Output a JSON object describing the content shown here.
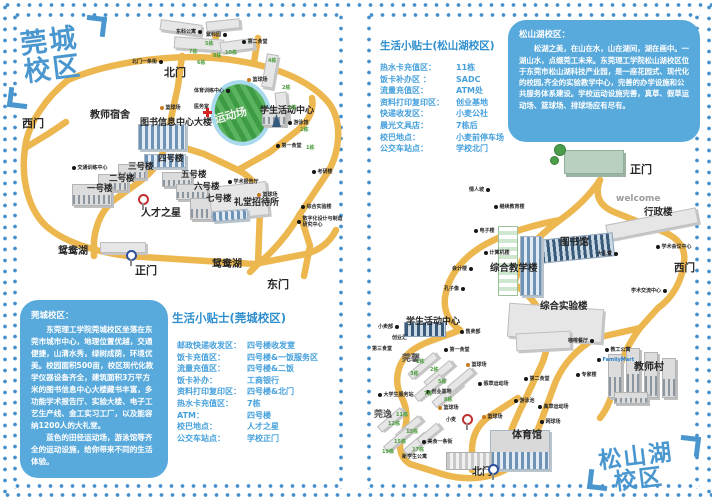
{
  "colors": {
    "accent_blue": "#2f8fce",
    "box_blue": "#58a9dc",
    "road_yellow": "#edb74f",
    "dot_blue": "#4590cd",
    "field_green": "#3d9b44"
  },
  "left": {
    "logo": {
      "line1": "莞城",
      "line2": "校区"
    },
    "intro": {
      "title": "莞城校区：",
      "p1": "东莞理工学院莞城校区坐落在东莞市城市中心，地理位置优越，交通便捷，山清水秀，绿树成荫，环境优美。校园面积500亩，校区现代化教学仪器设备齐全，建筑面积3万平方米的图书信息中心大楼藏书丰富，多功能学术报告厅、实验大楼、电子工艺生产线、金工实习工厂，以及能容纳1200人的大礼堂。",
      "p2": "蓝色的田径运动场，游泳馆等齐全的运动设施，给你带来不同的生活体验。"
    },
    "tips": {
      "title": "生活小贴士(莞城校区)",
      "rows": [
        [
          "邮政快递收发区：",
          "四号楼收发室"
        ],
        [
          "饭卡充值区：",
          "四号楼&一饭服务区"
        ],
        [
          "流量充值区：",
          "四号楼&二饭"
        ],
        [
          "饭卡补办：",
          "工商银行"
        ],
        [
          "资料打印复印区：",
          "四号楼&北门"
        ],
        [
          "热水卡充值区：",
          "7栋"
        ],
        [
          "ATM：",
          "四号楼"
        ],
        [
          "校巴地点：",
          "人才之星"
        ],
        [
          "公交车站点：",
          "学校正门"
        ]
      ]
    },
    "map": {
      "buildings": [
        {
          "x": 146,
          "y": 8,
          "w": 42,
          "h": 11,
          "r": 8,
          "c": "pl"
        },
        {
          "x": 192,
          "y": 6,
          "w": 34,
          "h": 10,
          "r": -6,
          "c": "pl"
        },
        {
          "x": 160,
          "y": 24,
          "w": 50,
          "h": 12,
          "r": 4,
          "c": "pl"
        },
        {
          "x": 206,
          "y": 26,
          "w": 34,
          "h": 11,
          "r": -8,
          "c": "pl"
        },
        {
          "x": 250,
          "y": 40,
          "w": 12,
          "h": 34,
          "r": 10,
          "c": "pl"
        },
        {
          "x": 262,
          "y": 78,
          "w": 12,
          "h": 30,
          "r": -6,
          "c": "pl"
        },
        {
          "x": 124,
          "y": 110,
          "w": 48,
          "h": 26,
          "r": 0,
          "c": "wn"
        },
        {
          "x": 130,
          "y": 140,
          "w": 42,
          "h": 14,
          "r": 0,
          "c": "wn"
        },
        {
          "x": 104,
          "y": 150,
          "w": 28,
          "h": 15,
          "r": 0,
          "c": "bd"
        },
        {
          "x": 84,
          "y": 160,
          "w": 30,
          "h": 17,
          "r": 0,
          "c": "bd"
        },
        {
          "x": 58,
          "y": 170,
          "w": 40,
          "h": 22,
          "r": 0,
          "c": "bd"
        },
        {
          "x": 148,
          "y": 158,
          "w": 30,
          "h": 15,
          "r": 0,
          "c": "bd"
        },
        {
          "x": 162,
          "y": 170,
          "w": 32,
          "h": 16,
          "r": 0,
          "c": "bd"
        },
        {
          "x": 176,
          "y": 184,
          "w": 40,
          "h": 22,
          "r": 0,
          "c": "bd"
        },
        {
          "x": 196,
          "y": 170,
          "w": 58,
          "h": 34,
          "r": -6,
          "c": "pl"
        },
        {
          "x": 198,
          "y": 196,
          "w": 36,
          "h": 11,
          "r": -4,
          "c": "wn"
        },
        {
          "x": 86,
          "y": 228,
          "w": 46,
          "h": 11,
          "r": 0,
          "c": "pl"
        },
        {
          "x": 248,
          "y": 94,
          "w": 24,
          "h": 18,
          "r": 0,
          "c": "bd"
        },
        {
          "x": 258,
          "y": 100,
          "w": 9,
          "h": 13,
          "r": 0,
          "c": "stat"
        }
      ],
      "labels": [
        {
          "t": "北门",
          "x": 150,
          "y": 50,
          "s": 11
        },
        {
          "t": "西门",
          "x": 8,
          "y": 101,
          "s": 11
        },
        {
          "t": "教师宿舍",
          "x": 76,
          "y": 92,
          "s": 10
        },
        {
          "t": "图书信息中心大楼",
          "x": 126,
          "y": 101,
          "s": 9
        },
        {
          "t": "四号楼",
          "x": 144,
          "y": 138,
          "s": 8.5
        },
        {
          "t": "三号楼",
          "x": 114,
          "y": 146,
          "s": 8.5
        },
        {
          "t": "二号楼",
          "x": 95,
          "y": 158,
          "s": 8.5
        },
        {
          "t": "一号楼",
          "x": 73,
          "y": 168,
          "s": 8.5
        },
        {
          "t": "五号楼",
          "x": 167,
          "y": 154,
          "s": 8.5
        },
        {
          "t": "六号楼",
          "x": 180,
          "y": 166,
          "s": 8.5
        },
        {
          "t": "七号楼",
          "x": 192,
          "y": 178,
          "s": 8.5
        },
        {
          "t": "人才之星",
          "x": 127,
          "y": 190,
          "s": 10
        },
        {
          "t": "礼堂招待所",
          "x": 220,
          "y": 181,
          "s": 9
        },
        {
          "t": "学生活动中心",
          "x": 246,
          "y": 89,
          "s": 9
        },
        {
          "t": "鸳鸯湖",
          "x": 44,
          "y": 228,
          "s": 10
        },
        {
          "t": "鸳鸯湖",
          "x": 198,
          "y": 241,
          "s": 10
        },
        {
          "t": "正门",
          "x": 121,
          "y": 248,
          "s": 11
        },
        {
          "t": "东门",
          "x": 253,
          "y": 262,
          "s": 11
        },
        {
          "t": "运动场",
          "x": 200,
          "y": 93,
          "s": 11,
          "cls": "wt",
          "r": -15
        },
        {
          "t": "东科公寓",
          "x": 162,
          "y": 14,
          "cls": "dt",
          "rev": 1
        },
        {
          "t": "紫科园",
          "x": 192,
          "y": 17,
          "cls": "dt",
          "rev": 1
        },
        {
          "t": "第二食堂",
          "x": 228,
          "y": 24,
          "cls": "dt"
        },
        {
          "t": "北门一条街",
          "x": 118,
          "y": 44,
          "cls": "dt",
          "rev": 1
        },
        {
          "t": "体育训练中心",
          "x": 180,
          "y": 73,
          "cls": "dt",
          "rev": 1
        },
        {
          "t": "篮球场",
          "x": 233,
          "y": 62,
          "cls": "od"
        },
        {
          "t": "篮球场",
          "x": 146,
          "y": 90,
          "cls": "od"
        },
        {
          "t": "篮球场",
          "x": 243,
          "y": 177,
          "cls": "od"
        },
        {
          "t": "医务室",
          "x": 180,
          "y": 89,
          "cls": "ty"
        },
        {
          "t": "交通训练中心",
          "x": 58,
          "y": 150,
          "cls": "dt"
        },
        {
          "t": "游泳馆",
          "x": 274,
          "y": 105,
          "cls": "dt"
        },
        {
          "t": "第一食堂",
          "x": 262,
          "y": 128,
          "cls": "dt"
        },
        {
          "t": "考研楼",
          "x": 298,
          "y": 154,
          "cls": "dt"
        },
        {
          "t": "学术报告厅",
          "x": 214,
          "y": 164,
          "cls": "dt"
        },
        {
          "t": "综合实验楼",
          "x": 287,
          "y": 189,
          "cls": "dt"
        },
        {
          "t": "数字化设计与制造研究中心",
          "x": 283,
          "y": 202,
          "cls": "dt",
          "w": 46
        },
        {
          "t": "7栋",
          "x": 175,
          "y": 34,
          "cls": "gn"
        },
        {
          "t": "6栋",
          "x": 183,
          "y": 45,
          "cls": "gn"
        },
        {
          "t": "5栋",
          "x": 191,
          "y": 26,
          "cls": "gn"
        },
        {
          "t": "8栋",
          "x": 199,
          "y": 38,
          "cls": "gn"
        },
        {
          "t": "10栋",
          "x": 211,
          "y": 35,
          "cls": "gn"
        },
        {
          "t": "4栋",
          "x": 254,
          "y": 43,
          "cls": "gn"
        },
        {
          "t": "2栋",
          "x": 268,
          "y": 70,
          "cls": "gn"
        },
        {
          "t": "1栋",
          "x": 274,
          "y": 90,
          "cls": "gn"
        },
        {
          "t": "2栋",
          "x": 286,
          "y": 112,
          "cls": "gn"
        },
        {
          "t": "1栋",
          "x": 292,
          "y": 130,
          "cls": "gn"
        }
      ],
      "pins": [
        {
          "x": 124,
          "y": 180,
          "k": "r"
        },
        {
          "x": 112,
          "y": 236,
          "k": "b"
        },
        {
          "x": 189,
          "y": 94,
          "k": "cross"
        }
      ]
    }
  },
  "right": {
    "logo": {
      "line1": "松山湖",
      "line2": "校区"
    },
    "intro": {
      "title": "松山湖校区：",
      "p1": "松湖之美，在山在水，山在湖间，湖在画中。一湖山水，点缀莞工未来。东莞理工学院松山湖校区位于东莞市松山湖科技产业园，是一座花园式、现代化的校园,齐全的实验教学中心，完善的办学设施和公共服务体系建设。学校运动设施完善，真草、假草运动场、篮球场、排球场应有尽有。"
    },
    "tips": {
      "title": "生活小贴士(松山湖校区)",
      "rows": [
        [
          "热水卡充值区：",
          "11栋"
        ],
        [
          "饭卡补办区 ：",
          "SADC"
        ],
        [
          "流量充值区：",
          "ATM处"
        ],
        [
          "资料打印复印区：",
          "创业基地"
        ],
        [
          "快递收发区：",
          "小麦公社"
        ],
        [
          "晨光文具店：",
          "7栋后"
        ],
        [
          "校巴地点：",
          "小麦前停车场"
        ],
        [
          "公交车站点：",
          "学校北门"
        ]
      ]
    },
    "map": {
      "buildings": [
        {
          "x": 196,
          "y": 10,
          "w": 60,
          "h": 24,
          "r": 0,
          "c": "gt"
        },
        {
          "x": 186,
          "y": 4,
          "w": 12,
          "h": 12,
          "r": 0,
          "c": "tr"
        },
        {
          "x": 182,
          "y": 16,
          "w": 9,
          "h": 9,
          "r": 0,
          "c": "tr"
        },
        {
          "x": 238,
          "y": 76,
          "w": 92,
          "h": 16,
          "r": -11,
          "c": "pl"
        },
        {
          "x": 172,
          "y": 96,
          "w": 74,
          "h": 24,
          "r": -6,
          "c": "dk"
        },
        {
          "x": 130,
          "y": 86,
          "w": 20,
          "h": 70,
          "r": 0,
          "c": "gn2"
        },
        {
          "x": 152,
          "y": 96,
          "w": 22,
          "h": 60,
          "r": 0,
          "c": "wn"
        },
        {
          "x": 140,
          "y": 166,
          "w": 95,
          "h": 34,
          "r": 4,
          "c": "pl"
        },
        {
          "x": 148,
          "y": 192,
          "w": 55,
          "h": 18,
          "r": -3,
          "c": "pl"
        },
        {
          "x": 36,
          "y": 182,
          "w": 42,
          "h": 15,
          "r": 0,
          "c": "dk"
        },
        {
          "x": 122,
          "y": 290,
          "w": 60,
          "h": 40,
          "r": 0,
          "c": "wn2"
        },
        {
          "x": 78,
          "y": 312,
          "w": 46,
          "h": 18,
          "r": 0,
          "c": "st"
        },
        {
          "x": 240,
          "y": 214,
          "w": 14,
          "h": 44,
          "r": 0,
          "c": "bd"
        },
        {
          "x": 258,
          "y": 208,
          "w": 14,
          "h": 50,
          "r": 0,
          "c": "bd"
        },
        {
          "x": 276,
          "y": 212,
          "w": 14,
          "h": 46,
          "r": 0,
          "c": "bd"
        },
        {
          "x": 294,
          "y": 218,
          "w": 14,
          "h": 40,
          "r": 0,
          "c": "bd"
        },
        {
          "x": 246,
          "y": 252,
          "w": 34,
          "h": 12,
          "r": 0,
          "c": "bd"
        },
        {
          "x": 38,
          "y": 222,
          "w": 34,
          "h": 8,
          "r": -40,
          "c": "pl"
        },
        {
          "x": 54,
          "y": 230,
          "w": 34,
          "h": 8,
          "r": -40,
          "c": "pl"
        },
        {
          "x": 44,
          "y": 244,
          "w": 34,
          "h": 8,
          "r": -40,
          "c": "pl"
        },
        {
          "x": 62,
          "y": 250,
          "w": 34,
          "h": 8,
          "r": -40,
          "c": "pl"
        },
        {
          "x": 78,
          "y": 236,
          "w": 30,
          "h": 8,
          "r": -40,
          "c": "pl"
        },
        {
          "x": 8,
          "y": 276,
          "w": 30,
          "h": 8,
          "r": -40,
          "c": "pl"
        },
        {
          "x": 26,
          "y": 284,
          "w": 30,
          "h": 8,
          "r": -40,
          "c": "pl"
        },
        {
          "x": 14,
          "y": 296,
          "w": 30,
          "h": 8,
          "r": -40,
          "c": "pl"
        },
        {
          "x": 34,
          "y": 300,
          "w": 28,
          "h": 8,
          "r": -40,
          "c": "pl"
        },
        {
          "x": 48,
          "y": 290,
          "w": 26,
          "h": 8,
          "r": -40,
          "c": "pl"
        }
      ],
      "labels": [
        {
          "t": "正门",
          "x": 262,
          "y": 21,
          "s": 11
        },
        {
          "t": "welcome",
          "x": 248,
          "y": 54,
          "s": 9,
          "cls": "gy"
        },
        {
          "t": "行政楼",
          "x": 276,
          "y": 64,
          "s": 9.5
        },
        {
          "t": "图书馆",
          "x": 192,
          "y": 94,
          "s": 9.5
        },
        {
          "t": "西门",
          "x": 306,
          "y": 120,
          "s": 10.5
        },
        {
          "t": "综合教学楼",
          "x": 122,
          "y": 120,
          "s": 9.5
        },
        {
          "t": "综合实验楼",
          "x": 172,
          "y": 158,
          "s": 9.5
        },
        {
          "t": "学生活动中心",
          "x": 38,
          "y": 174,
          "s": 9
        },
        {
          "t": "莞馨",
          "x": 34,
          "y": 211,
          "s": 9,
          "cls": "hs"
        },
        {
          "t": "莞逸",
          "x": 6,
          "y": 267,
          "s": 9,
          "cls": "hs"
        },
        {
          "t": "体育馆",
          "x": 144,
          "y": 286,
          "s": 10
        },
        {
          "t": "北门",
          "x": 104,
          "y": 323,
          "s": 10
        },
        {
          "t": "教师村",
          "x": 266,
          "y": 218,
          "s": 10
        },
        {
          "t": "情人坡",
          "x": 101,
          "y": 46,
          "cls": "dt",
          "rev": 1
        },
        {
          "t": "继续教育楼",
          "x": 126,
          "y": 63,
          "cls": "dt"
        },
        {
          "t": "电子楼",
          "x": 106,
          "y": 87,
          "cls": "dt"
        },
        {
          "t": "计算机楼",
          "x": 116,
          "y": 109,
          "cls": "dt"
        },
        {
          "t": "会计楼",
          "x": 84,
          "y": 125,
          "cls": "dt",
          "rev": 1
        },
        {
          "t": "孔子像",
          "x": 76,
          "y": 145,
          "cls": "dt",
          "rev": 1
        },
        {
          "t": "大礼堂",
          "x": 229,
          "y": 110,
          "cls": "dt",
          "rev": 1
        },
        {
          "t": "学术会议中心",
          "x": 288,
          "y": 103,
          "cls": "dt"
        },
        {
          "t": "学术交流中心",
          "x": 263,
          "y": 147,
          "cls": "dt",
          "rev": 1
        },
        {
          "t": "教工公寓",
          "x": 237,
          "y": 206,
          "cls": "dt"
        },
        {
          "t": "FamilyMart",
          "x": 229,
          "y": 217,
          "cls": "bl"
        },
        {
          "t": "专家楼",
          "x": 208,
          "y": 231,
          "cls": "dt"
        },
        {
          "t": "咖啡餐厅",
          "x": 200,
          "y": 197,
          "cls": "dt",
          "rev": 1
        },
        {
          "t": "售卖部",
          "x": 92,
          "y": 188,
          "cls": "dt"
        },
        {
          "t": "小卖部",
          "x": 10,
          "y": 183,
          "cls": "dt",
          "rev": 1
        },
        {
          "t": "创业汇",
          "x": 24,
          "y": 194,
          "cls": "ty"
        },
        {
          "t": "第三食堂",
          "x": 4,
          "y": 205,
          "cls": "ty"
        },
        {
          "t": "第一食堂",
          "x": 76,
          "y": 206,
          "cls": "dt"
        },
        {
          "t": "第二食堂",
          "x": 156,
          "y": 235,
          "cls": "dt"
        },
        {
          "t": "篮球场",
          "x": 98,
          "y": 221,
          "cls": "od"
        },
        {
          "t": "篮球场",
          "x": 114,
          "y": 273,
          "cls": "od"
        },
        {
          "t": "篮球场",
          "x": 70,
          "y": 264,
          "cls": "od"
        },
        {
          "t": "假草运动场",
          "x": 110,
          "y": 240,
          "cls": "dt"
        },
        {
          "t": "真草运动场",
          "x": 170,
          "y": 263,
          "cls": "dt"
        },
        {
          "t": "游泳池",
          "x": 146,
          "y": 257,
          "cls": "dt"
        },
        {
          "t": "网球场",
          "x": 172,
          "y": 278,
          "cls": "dt"
        },
        {
          "t": "美食一条街",
          "x": 54,
          "y": 298,
          "cls": "dt"
        },
        {
          "t": "新学生公寓",
          "x": 34,
          "y": 313,
          "cls": "ty"
        },
        {
          "t": "大学生服务站",
          "x": 10,
          "y": 251,
          "cls": "dt"
        },
        {
          "t": "创业基地",
          "x": 58,
          "y": 248,
          "cls": "dt"
        },
        {
          "t": "小麦",
          "x": 78,
          "y": 276,
          "cls": "ty"
        },
        {
          "t": "1栋",
          "x": 48,
          "y": 218,
          "cls": "gn"
        },
        {
          "t": "2栋",
          "x": 62,
          "y": 226,
          "cls": "gn"
        },
        {
          "t": "3栋",
          "x": 42,
          "y": 230,
          "cls": "gn"
        },
        {
          "t": "5栋",
          "x": 70,
          "y": 238,
          "cls": "gn"
        },
        {
          "t": "7栋",
          "x": 56,
          "y": 250,
          "cls": "gn"
        },
        {
          "t": "8栋",
          "x": 76,
          "y": 256,
          "cls": "gn"
        },
        {
          "t": "11栋",
          "x": 28,
          "y": 271,
          "cls": "gn"
        },
        {
          "t": "12栋",
          "x": 20,
          "y": 280,
          "cls": "gn"
        },
        {
          "t": "13栋",
          "x": 38,
          "y": 288,
          "cls": "gn"
        },
        {
          "t": "15栋",
          "x": 26,
          "y": 298,
          "cls": "gn"
        },
        {
          "t": "17栋",
          "x": 44,
          "y": 306,
          "cls": "gn"
        },
        {
          "t": "19栋",
          "x": 14,
          "y": 308,
          "cls": "gn"
        }
      ],
      "pins": [
        {
          "x": 94,
          "y": 274,
          "k": "r"
        },
        {
          "x": 120,
          "y": 324,
          "k": "b"
        }
      ]
    }
  }
}
